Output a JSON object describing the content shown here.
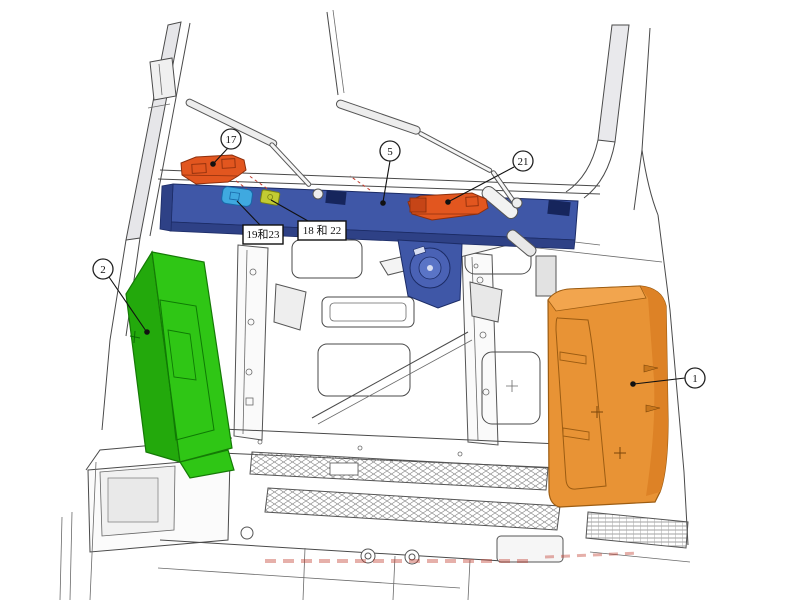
{
  "figure": {
    "background": "#ffffff",
    "line_color": "#4a4a4a"
  },
  "callouts": {
    "c17": "17",
    "c5": "5",
    "c21": "21",
    "c2": "2",
    "c1": "1"
  },
  "labels": {
    "box_19_23": "19和23",
    "box_18_22": "18 和 22"
  },
  "colors": {
    "cross_member_blue": "#3f57a7",
    "cross_member_dark": "#2e4186",
    "cross_member_edge": "#1c2c66",
    "left_panel_green": "#2fc615",
    "left_panel_green_side": "#23a90c",
    "right_panel_orange": "#e89335",
    "right_panel_orange_top": "#f2a54e",
    "right_panel_orange_side": "#dd8226",
    "bracket_orange_red": "#e2561f",
    "clip_cyan": "#3fa9e0",
    "clip_yellow_green": "#c2cb33"
  }
}
